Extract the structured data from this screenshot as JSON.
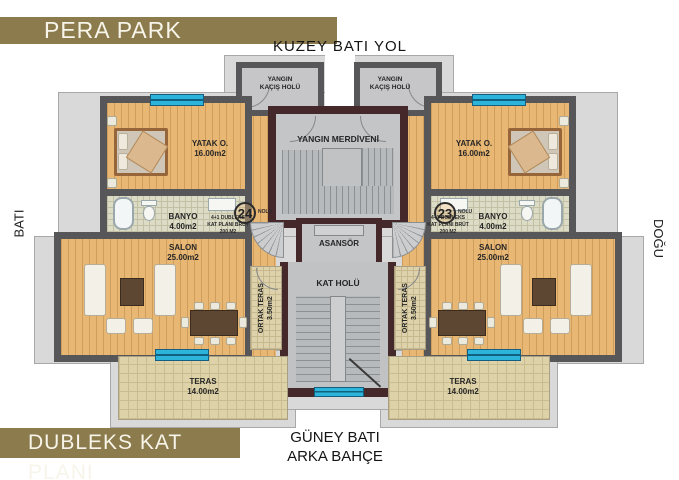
{
  "header": {
    "title": "PERA PARK"
  },
  "footer": {
    "plan_label": "DUBLEKS KAT PLANI"
  },
  "compass": {
    "top": "KUZEY BATI YOL",
    "left": "BATI",
    "right": "DOĞU",
    "bottom_line1": "GÜNEY BATI",
    "bottom_line2": "ARKA BAHÇE"
  },
  "rooms": {
    "fire_escape_hall": {
      "line1": "YANGIN",
      "line2": "KAÇIŞ HOLÜ"
    },
    "fire_stairs": {
      "label": "YANGIN MERDİVENİ"
    },
    "elevator": {
      "label": "ASANSÖR"
    },
    "floor_hall": {
      "label": "KAT HOLÜ"
    },
    "bedroom": {
      "name": "YATAK O.",
      "area": "16.00m2"
    },
    "bathroom": {
      "name": "BANYO",
      "area": "4.00m2"
    },
    "living_room": {
      "name": "SALON",
      "area": "25.00m2"
    },
    "common_terrace": {
      "name": "ORTAK TERAS",
      "area": "3.50m2"
    },
    "terrace": {
      "name": "TERAS",
      "area": "14.00m2"
    }
  },
  "units": {
    "left": {
      "number": "24",
      "suffix": "NOLU",
      "line1": "4+1 DUBLEKS",
      "line2": "KAT PLANI BRÜT",
      "line3": "200 M2"
    },
    "right": {
      "number": "23",
      "suffix": "NOLU",
      "line1": "4+1 DUBLEKS",
      "line2": "KAT PLANI BRÜT",
      "line3": "200 M2"
    }
  },
  "colors": {
    "banner_gold": "#8c7b4c",
    "wood_floor": "#e9b774",
    "window_cyan": "#2db4da",
    "core_wall": "#44282a",
    "apartment_wall": "#57575a",
    "terrace_tile": "#ded2a8",
    "hall_floor": "#c6c6c8",
    "roof_band": "#d9d9d9"
  }
}
